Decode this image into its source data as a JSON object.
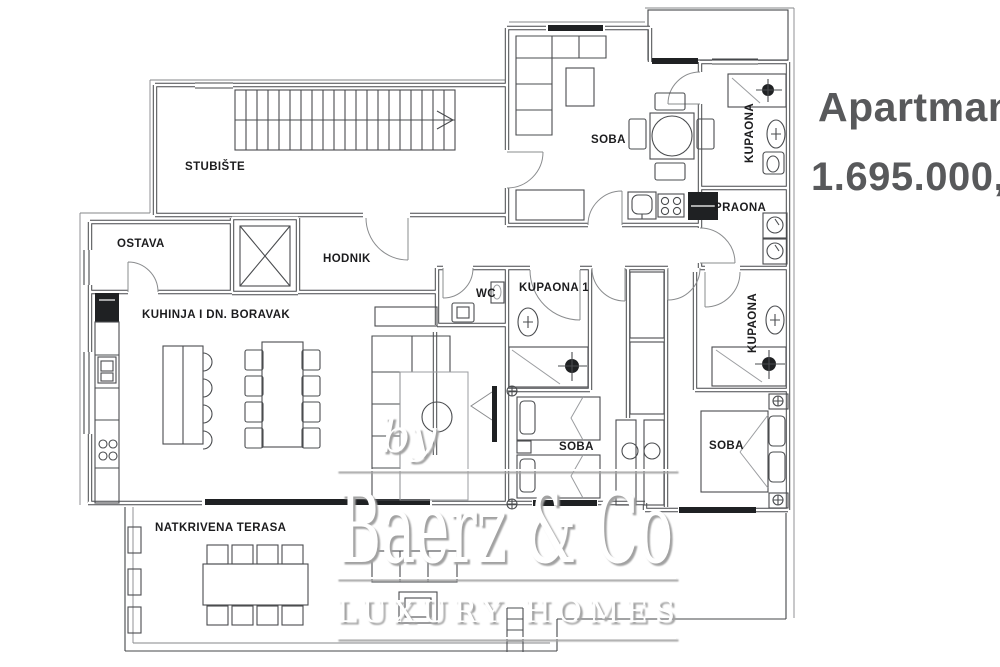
{
  "header": {
    "title": "Apartman",
    "price": "1.695.000,00"
  },
  "watermark": {
    "by": "by",
    "brand": "Baerz & Co",
    "tagline": "LUXURY HOMES"
  },
  "rooms": {
    "stubiste": "STUBIŠTE",
    "ostava": "OSTAVA",
    "hodnik": "HODNIK",
    "kuhinja": "KUHINJA I DN. BORAVAK",
    "soba_top": "SOBA",
    "kupaona_top": "KUPAONA",
    "praona": "PRAONA",
    "wc": "WC",
    "kupaona1": "KUPAONA 1",
    "kupaona_desna": "KUPAONA",
    "soba_sredina": "SOBA",
    "soba_desna": "SOBA",
    "terasa": "NATKRIVENA TERASA"
  },
  "colors": {
    "wall_line": "#45474a",
    "label_text": "#1c1c1e",
    "headline_text": "#58595b",
    "watermark_shadow": "#a2a2a2",
    "watermark_fill": "#ffffff"
  }
}
